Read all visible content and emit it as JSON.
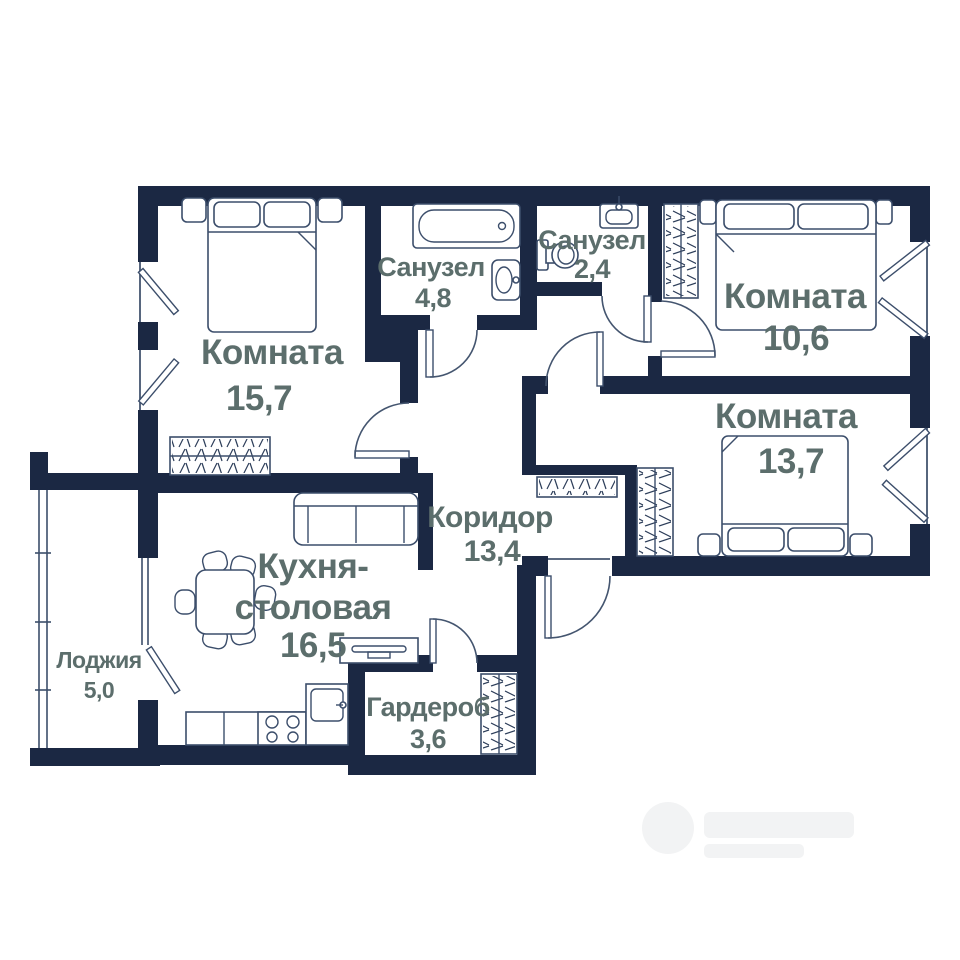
{
  "plan_title": "floor-plan",
  "colors": {
    "wall": "#1b2843",
    "furniture_line": "#3c4e6b",
    "label_text": "#5c6e6c",
    "background": "#ffffff"
  },
  "rooms": {
    "room_157": {
      "name": "Комната",
      "area": "15,7"
    },
    "bath_48": {
      "name": "Санузел",
      "area": "4,8"
    },
    "bath_24": {
      "name": "Санузел",
      "area": "2,4"
    },
    "room_106": {
      "name": "Комната",
      "area": "10,6"
    },
    "room_137": {
      "name": "Комната",
      "area": "13,7"
    },
    "corridor": {
      "name": "Коридор",
      "area": "13,4"
    },
    "kitchen": {
      "name_line1": "Кухня-",
      "name_line2": "столовая",
      "area": "16,5"
    },
    "wardrobe": {
      "name": "Гардероб",
      "area": "3,6"
    },
    "loggia": {
      "name": "Лоджия",
      "area": "5,0"
    }
  }
}
